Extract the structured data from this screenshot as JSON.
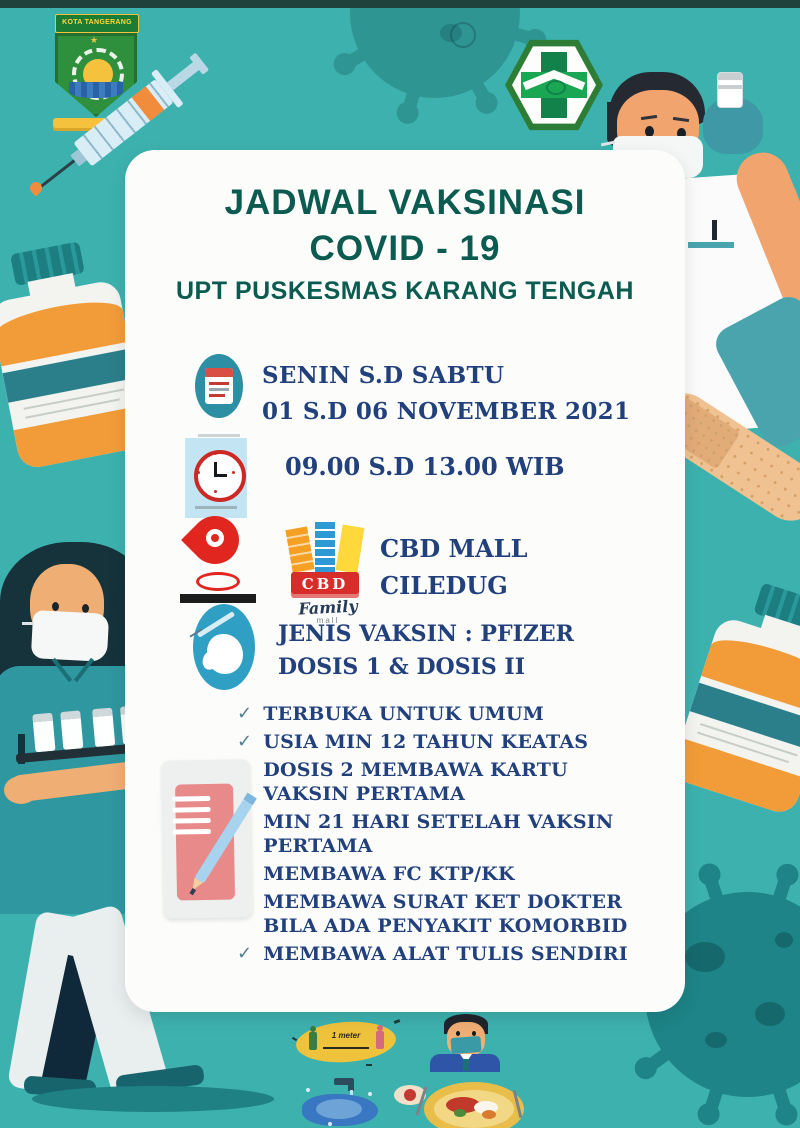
{
  "poster": {
    "colors": {
      "background": "#3db1ae",
      "card": "#fcfdfb",
      "title_green": "#0b5b50",
      "text_navy": "#21407c",
      "check": "#527e90",
      "brand_red": "#d62e2a",
      "pin_red": "#e1251f",
      "accent_orange": "#f29c39",
      "accent_teal": "#2d8fa3"
    },
    "icons": {
      "check": "✓"
    },
    "title": {
      "line1": "JADWAL VAKSINASI",
      "line2": "COVID - 19",
      "line3": "UPT PUSKESMAS KARANG TENGAH"
    },
    "schedule": {
      "days": "SENIN S.D SABTU",
      "dates": "01 S.D 06 NOVEMBER 2021",
      "time": "09.00 S.D 13.00 WIB"
    },
    "location": {
      "name": "CBD MALL",
      "area": "CILEDUG"
    },
    "vaccine": {
      "line1": "JENIS VAKSIN : PFIZER",
      "line2": "DOSIS 1 & DOSIS II"
    },
    "requirements": [
      "TERBUKA UNTUK UMUM",
      "USIA MIN 12 TAHUN KEATAS",
      "DOSIS 2 MEMBAWA KARTU VAKSIN PERTAMA",
      "MIN 21 HARI SETELAH VAKSIN PERTAMA",
      "MEMBAWA FC KTP/KK",
      "MEMBAWA SURAT KET DOKTER BILA ADA PENYAKIT KOMORBID",
      "MEMBAWA ALAT TULIS SENDIRI"
    ],
    "cbd_logo": {
      "brand": "CBD",
      "family": "Family",
      "mall": "mall"
    },
    "kota_logo": {
      "label": "KOTA TANGERANG"
    },
    "footer": {
      "distance_label": "1 meter"
    }
  }
}
